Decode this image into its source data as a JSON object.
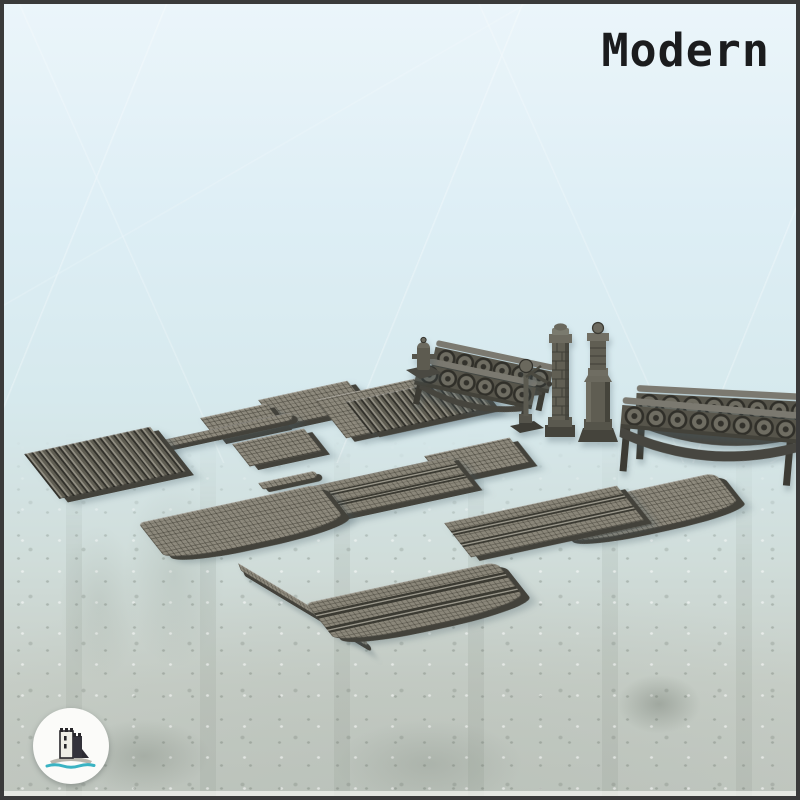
{
  "header": {
    "title": "Modern"
  },
  "brand": {
    "logo_icon": "castle-on-island-logo",
    "accent_color": "#3ab3c3"
  },
  "palette": {
    "background_top": "#ebf5fa",
    "background_bottom": "#c2c8c1",
    "model_gray_top": "#8a8679",
    "model_gray_side": "#43423b",
    "title_color": "#1b1c1e",
    "frame_color": "#3a3a3a"
  },
  "catalog": {
    "set_name": "Modern",
    "pieces": [
      {
        "id": "metal-deck-plate-large",
        "label": "Large ribbed metal deck plate"
      },
      {
        "id": "metal-deck-plate-medium",
        "label": "Medium ribbed metal deck plate"
      },
      {
        "id": "cobblestone-plate-medium",
        "label": "Medium cobblestone pavement plate"
      },
      {
        "id": "cobblestone-plate-large",
        "label": "Large cobblestone pavement plate"
      },
      {
        "id": "cobblestone-plate-small-1",
        "label": "Small cobblestone pavement plate"
      },
      {
        "id": "cobblestone-plate-small-2",
        "label": "Small cobblestone pavement plate"
      },
      {
        "id": "cobblestone-plate-wide",
        "label": "Wide cobblestone pavement plate"
      },
      {
        "id": "sidewalk-curb-long",
        "label": "Long straight curb strip"
      },
      {
        "id": "sidewalk-curb-short",
        "label": "Short curb strip"
      },
      {
        "id": "sidewalk-curb-curved",
        "label": "Curved curb strip"
      },
      {
        "id": "curved-road-left",
        "label": "Curved cobblestone road section"
      },
      {
        "id": "curved-road-right",
        "label": "Curved cobblestone road section"
      },
      {
        "id": "tram-road-small",
        "label": "Straight cobblestone road with tram tracks (small)"
      },
      {
        "id": "tram-road-large",
        "label": "Straight cobblestone road with tram tracks (large)"
      },
      {
        "id": "curved-tram-road",
        "label": "Curved cobblestone road with tram tracks"
      },
      {
        "id": "straight-bridge-railing-back",
        "label": "Straight bridge railing"
      },
      {
        "id": "straight-bridge-railing-front",
        "label": "Straight bridge railing"
      },
      {
        "id": "arched-bridge-railing-back",
        "label": "Arched bridge railing"
      },
      {
        "id": "arched-bridge-railing-front",
        "label": "Arched bridge railing"
      },
      {
        "id": "hydrant-bollard",
        "label": "Fire hydrant bollard"
      },
      {
        "id": "signal-lamp-post",
        "label": "Signal lamp post with ball finial"
      },
      {
        "id": "brick-pillar",
        "label": "Brick pillar"
      },
      {
        "id": "ornate-column",
        "label": "Ornate stone column"
      }
    ]
  }
}
